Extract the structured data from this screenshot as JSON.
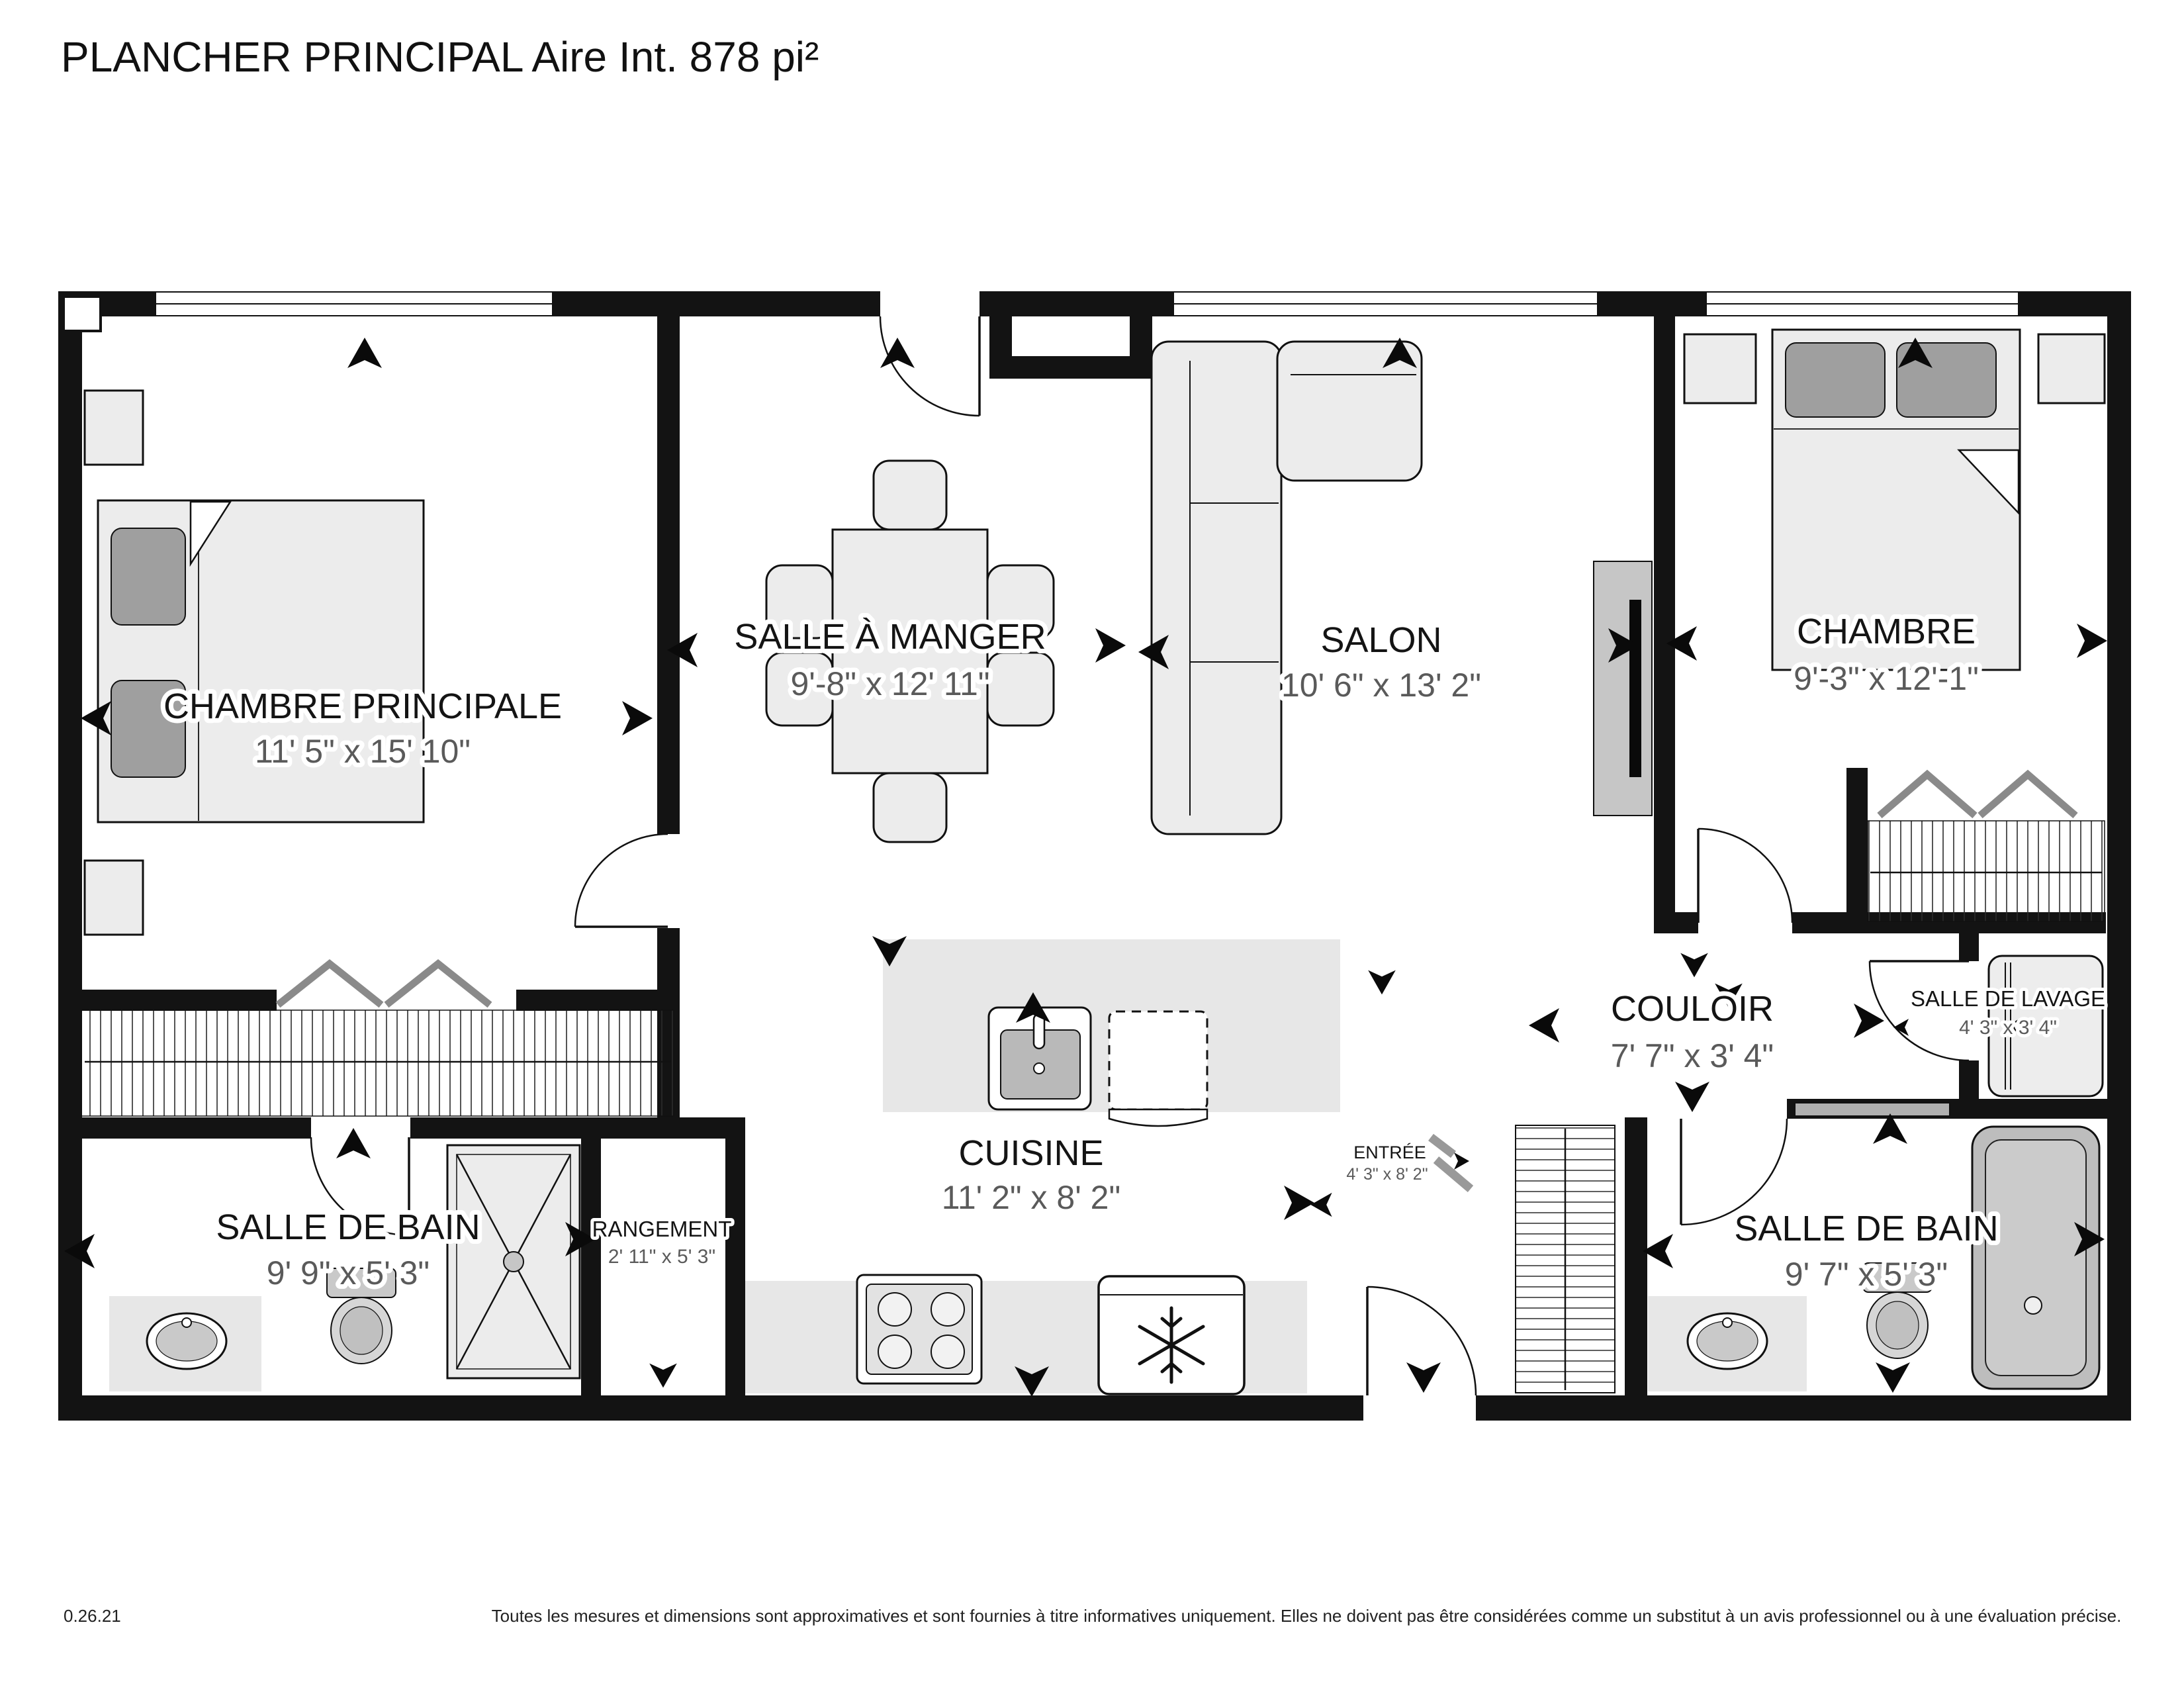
{
  "title": "PLANCHER PRINCIPAL Aire Int. 878 pi²",
  "rooms": [
    {
      "name": "CHAMBRE PRINCIPALE",
      "dimensions": "11' 5\" x 15' 10\""
    },
    {
      "name": "SALLE À MANGER",
      "dimensions": "9'-8\" x 12' 11\""
    },
    {
      "name": "SALON",
      "dimensions": "10' 6\" x 13' 2\""
    },
    {
      "name": "CHAMBRE",
      "dimensions": "9'-3\" x 12'-1\""
    },
    {
      "name": "COULOIR",
      "dimensions": "7' 7\" x 3' 4\""
    },
    {
      "name": "SALLE DE LAVAGE",
      "dimensions": "4' 3\" x 3' 4\""
    },
    {
      "name": "SALLE DE BAIN",
      "dimensions": "9' 9\" x 5' 3\""
    },
    {
      "name": "RANGEMENT",
      "dimensions": "2' 11\" x 5' 3\""
    },
    {
      "name": "CUISINE",
      "dimensions": "11' 2\" x 8' 2\""
    },
    {
      "name": "ENTRÉE",
      "dimensions": "4' 3\" x 8' 2\""
    },
    {
      "name": "SALLE DE BAIN",
      "dimensions": "9' 7\" x 5' 3\""
    }
  ],
  "footer": {
    "version": "0.26.21",
    "disclaimer": "Toutes les mesures et dimensions sont approximatives et sont fournies à titre informatives uniquement. Elles ne doivent pas être considérées comme un substitut à un avis professionnel ou à une évaluation précise."
  },
  "colors": {
    "wall": "#131313",
    "furniture_fill": "#ececec",
    "floor_accent": "#e7e7e7",
    "label_text": "#141414",
    "dimension_text": "#5a5a5a",
    "background": "#ffffff"
  }
}
